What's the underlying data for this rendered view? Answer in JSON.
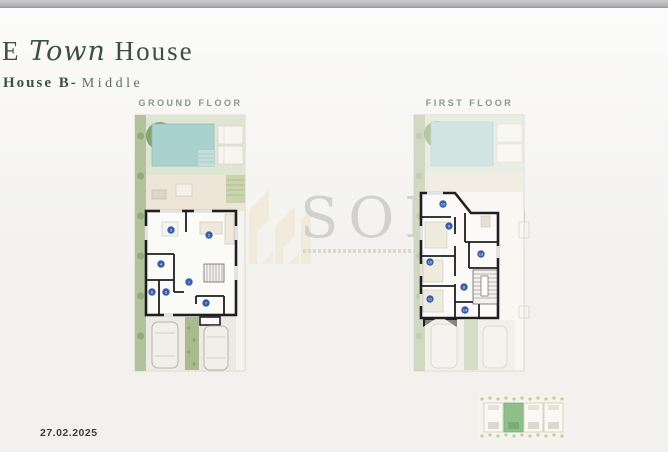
{
  "header": {
    "title_pre": "E",
    "title_script": "Town",
    "title_main": "House",
    "subtitle_primary": "House B-",
    "subtitle_secondary": "Middle"
  },
  "plans": {
    "ground": {
      "label": "GROUND FLOOR",
      "rooms": [
        {
          "n": "1",
          "x": 61,
          "y": 168
        },
        {
          "n": "2",
          "x": 81,
          "y": 121
        },
        {
          "n": "3",
          "x": 43,
          "y": 116
        },
        {
          "n": "4",
          "x": 33,
          "y": 150
        },
        {
          "n": "5",
          "x": 38,
          "y": 178
        },
        {
          "n": "6",
          "x": 24,
          "y": 178
        },
        {
          "n": "7",
          "x": 78,
          "y": 189
        }
      ]
    },
    "first": {
      "label": "FIRST FLOOR",
      "rooms": [
        {
          "n": "8",
          "x": 57,
          "y": 173
        },
        {
          "n": "9",
          "x": 42,
          "y": 112
        },
        {
          "n": "10",
          "x": 23,
          "y": 148
        },
        {
          "n": "11",
          "x": 23,
          "y": 185
        },
        {
          "n": "12",
          "x": 36,
          "y": 90
        },
        {
          "n": "13",
          "x": 74,
          "y": 140
        },
        {
          "n": "14",
          "x": 58,
          "y": 196
        }
      ]
    }
  },
  "watermark": {
    "brand": "SOLID"
  },
  "keyplan": {
    "units": 4,
    "highlighted_unit": 2
  },
  "footer": {
    "date": "27.02.2025"
  },
  "colors": {
    "title": "#3d4f4b",
    "floor_label": "#8b948e",
    "room_badge": "#3a5ca6",
    "pool": "#a9d2cf",
    "garden": "#b3c29c",
    "highlight": "#8fbf8a",
    "wall": "#1f1f22"
  }
}
